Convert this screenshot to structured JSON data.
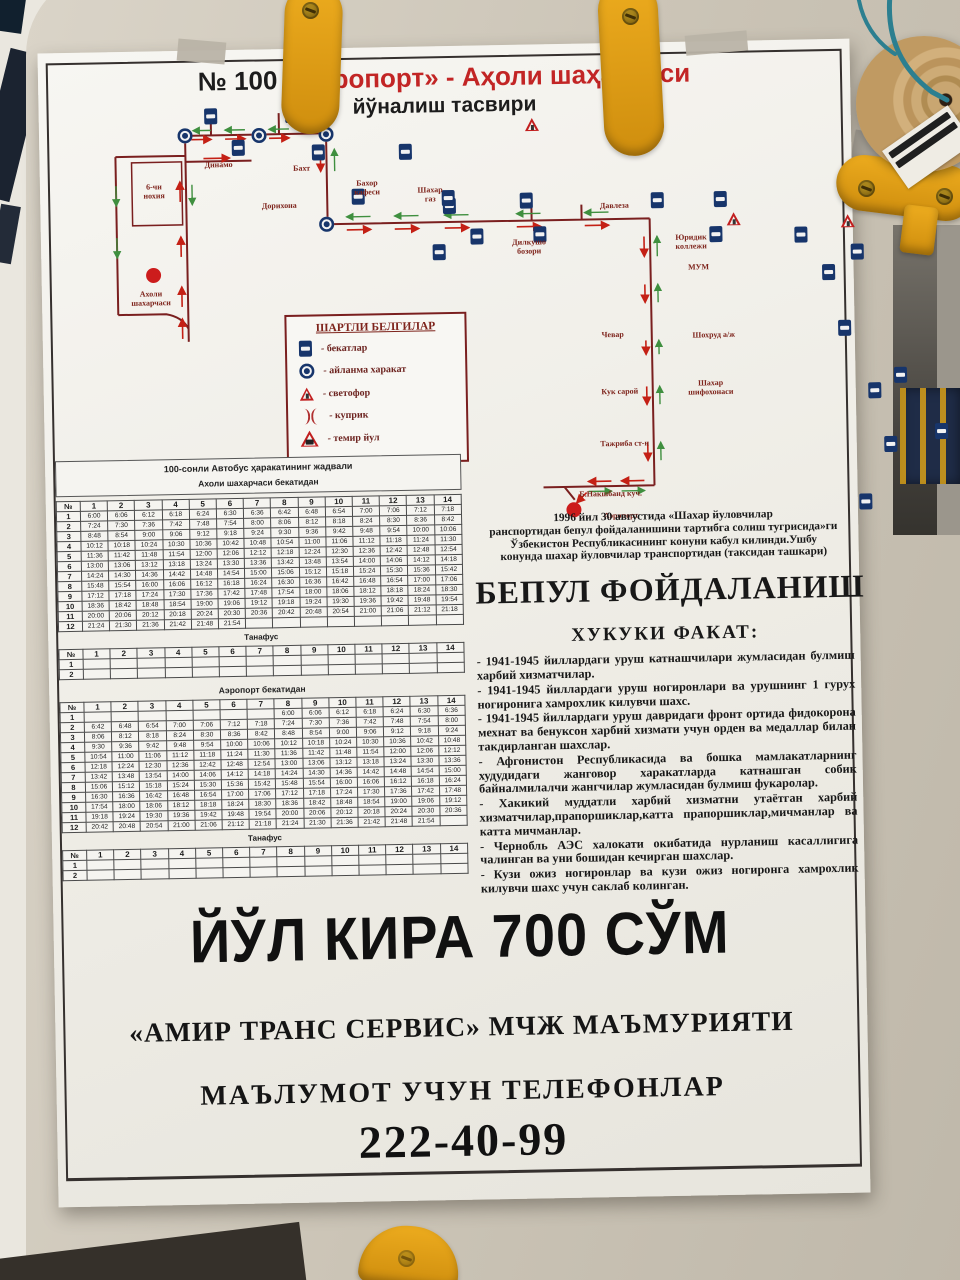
{
  "colors": {
    "poster_red": "#c22525",
    "map_road": "#7a1f1f",
    "map_blue": "#17356b",
    "arrow_red": "#c42015",
    "arrow_green": "#3f8f3f",
    "tab_yellow": "#e2a51c"
  },
  "title": {
    "no": "№ 100",
    "route": "«Аэропорт» - Аҳоли шаҳарчаси",
    "subtitle": "йўналиш тасвири"
  },
  "map": {
    "legend": {
      "title": "ШАРТЛИ БЕЛГИЛАР",
      "items": [
        {
          "icon": "bus-stop-icon",
          "label": "- бекатлар"
        },
        {
          "icon": "roundabout-icon",
          "label": "- айланма харакат"
        },
        {
          "icon": "traffic-light-icon",
          "label": "- светофор"
        },
        {
          "icon": "bridge-icon",
          "label": "- куприк"
        },
        {
          "icon": "railway-icon",
          "label": "- темир йул"
        }
      ]
    },
    "stops": [
      [
        158,
        10
      ],
      [
        226,
        10
      ],
      [
        159,
        42
      ],
      [
        226,
        48
      ],
      [
        252,
        93
      ],
      [
        287,
        49
      ],
      [
        317,
        104
      ],
      [
        381,
        100
      ],
      [
        318,
        135
      ],
      [
        368,
        134
      ],
      [
        473,
        102
      ],
      [
        523,
        102
      ],
      [
        505,
        137
      ],
      [
        577,
        139
      ],
      [
        620,
        157
      ],
      [
        578,
        177
      ],
      [
        580,
        233
      ],
      [
        622,
        281
      ],
      [
        583,
        296
      ],
      [
        585,
        350
      ],
      [
        623,
        338
      ],
      [
        533,
        407
      ],
      [
        98,
        150
      ],
      [
        95,
        96
      ]
    ],
    "roundabouts": [
      [
        132,
        29
      ],
      [
        206,
        30
      ],
      [
        273,
        30
      ],
      [
        272,
        120
      ]
    ],
    "traffic_lights": [
      [
        167,
        21
      ],
      [
        353,
        119
      ],
      [
        453,
        123
      ],
      [
        596,
        124
      ],
      [
        597,
        168
      ],
      [
        599,
        213
      ],
      [
        600,
        259
      ],
      [
        603,
        318
      ],
      [
        496,
        389
      ],
      [
        606,
        388
      ]
    ],
    "railways": [
      [
        623,
        240
      ]
    ],
    "termini": [
      [
        98,
        168
      ],
      [
        514,
        410
      ]
    ],
    "turns": [
      [
        325,
        228
      ]
    ],
    "labels": [
      {
        "x": 165,
        "y": 55,
        "t": "Динамо"
      },
      {
        "x": 248,
        "y": 60,
        "t": "Бахт"
      },
      {
        "x": 225,
        "y": 97,
        "t": "Дорихона"
      },
      {
        "x": 313,
        "y": 76,
        "t": "Бахор\nкафеси"
      },
      {
        "x": 376,
        "y": 84,
        "t": "Шахар\nгаз"
      },
      {
        "x": 100,
        "y": 76,
        "t": "6-чи\nнохия"
      },
      {
        "x": 95,
        "y": 183,
        "t": "Ахоли\nшахарчаси"
      },
      {
        "x": 474,
        "y": 138,
        "t": "Дилкушо\nбозори"
      },
      {
        "x": 560,
        "y": 103,
        "t": "Давлеза"
      },
      {
        "x": 636,
        "y": 136,
        "t": "Юридик\nколлежи"
      },
      {
        "x": 643,
        "y": 166,
        "t": "МУМ"
      },
      {
        "x": 556,
        "y": 232,
        "t": "Чевар"
      },
      {
        "x": 657,
        "y": 234,
        "t": "Шохруд а/ж"
      },
      {
        "x": 562,
        "y": 289,
        "t": "Кук сарой"
      },
      {
        "x": 653,
        "y": 282,
        "t": "Шахар\nшифохонаси"
      },
      {
        "x": 566,
        "y": 341,
        "t": "Тажриба ст-н"
      },
      {
        "x": 551,
        "y": 391,
        "t": "Б.Накшбанд куч."
      },
      {
        "x": 561,
        "y": 413,
        "t": "Аэропорт"
      }
    ]
  },
  "timetable": {
    "title": "100-сонли Автобус ҳаракатининг жадвали",
    "section1": "Ахоли шахарчаси бекатидан",
    "section2": "Аэропорт бекатидан",
    "tanafus_label": "Танафус",
    "col_headers": [
      "№",
      "1",
      "2",
      "3",
      "4",
      "5",
      "6",
      "7",
      "8",
      "9",
      "10",
      "11",
      "12",
      "13",
      "14"
    ],
    "table1_rows": [
      {
        "n": "1",
        "t": [
          "6:00",
          "6:06",
          "6:12",
          "6:18",
          "6:24",
          "6:30",
          "6:36",
          "6:42",
          "6:48",
          "6:54",
          "7:00",
          "7:06",
          "7:12",
          "7:18"
        ]
      },
      {
        "n": "2",
        "t": [
          "7:24",
          "7:30",
          "7:36",
          "7:42",
          "7:48",
          "7:54",
          "8:00",
          "8:06",
          "8:12",
          "8:18",
          "8:24",
          "8:30",
          "8:36",
          "8:42"
        ]
      },
      {
        "n": "3",
        "t": [
          "8:48",
          "8:54",
          "9:00",
          "9:06",
          "9:12",
          "9:18",
          "9:24",
          "9:30",
          "9:36",
          "9:42",
          "9:48",
          "9:54",
          "10:00",
          "10:06"
        ]
      },
      {
        "n": "4",
        "t": [
          "10:12",
          "10:18",
          "10:24",
          "10:30",
          "10:36",
          "10:42",
          "10:48",
          "10:54",
          "11:00",
          "11:06",
          "11:12",
          "11:18",
          "11:24",
          "11:30"
        ]
      },
      {
        "n": "5",
        "t": [
          "11:36",
          "11:42",
          "11:48",
          "11:54",
          "12:00",
          "12:06",
          "12:12",
          "12:18",
          "12:24",
          "12:30",
          "12:36",
          "12:42",
          "12:48",
          "12:54"
        ]
      },
      {
        "n": "6",
        "t": [
          "13:00",
          "13:06",
          "13:12",
          "13:18",
          "13:24",
          "13:30",
          "13:36",
          "13:42",
          "13:48",
          "13:54",
          "14:00",
          "14:06",
          "14:12",
          "14:18"
        ]
      },
      {
        "n": "7",
        "t": [
          "14:24",
          "14:30",
          "14:36",
          "14:42",
          "14:48",
          "14:54",
          "15:00",
          "15:06",
          "15:12",
          "15:18",
          "15:24",
          "15:30",
          "15:36",
          "15:42"
        ]
      },
      {
        "n": "8",
        "t": [
          "15:48",
          "15:54",
          "16:00",
          "16:06",
          "16:12",
          "16:18",
          "16:24",
          "16:30",
          "16:36",
          "16:42",
          "16:48",
          "16:54",
          "17:00",
          "17:06"
        ]
      },
      {
        "n": "9",
        "t": [
          "17:12",
          "17:18",
          "17:24",
          "17:30",
          "17:36",
          "17:42",
          "17:48",
          "17:54",
          "18:00",
          "18:06",
          "18:12",
          "18:18",
          "18:24",
          "18:30"
        ]
      },
      {
        "n": "10",
        "t": [
          "18:36",
          "18:42",
          "18:48",
          "18:54",
          "19:00",
          "19:06",
          "19:12",
          "19:18",
          "19:24",
          "19:30",
          "19:36",
          "19:42",
          "19:48",
          "19:54"
        ]
      },
      {
        "n": "11",
        "t": [
          "20:00",
          "20:06",
          "20:12",
          "20:18",
          "20:24",
          "20:30",
          "20:36",
          "20:42",
          "20:48",
          "20:54",
          "21:00",
          "21:06",
          "21:12",
          "21:18"
        ]
      },
      {
        "n": "12",
        "t": [
          "21:24",
          "21:30",
          "21:36",
          "21:42",
          "21:48",
          "21:54",
          "",
          "",
          "",
          "",
          "",
          "",
          "",
          ""
        ]
      }
    ],
    "table2_rows": [
      {
        "n": "1",
        "t": [
          "",
          "",
          "",
          "",
          "",
          "",
          "",
          "6:00",
          "6:06",
          "6:12",
          "6:18",
          "6:24",
          "6:30",
          "6:36"
        ]
      },
      {
        "n": "2",
        "t": [
          "6:42",
          "6:48",
          "6:54",
          "7:00",
          "7:06",
          "7:12",
          "7:18",
          "7:24",
          "7:30",
          "7:36",
          "7:42",
          "7:48",
          "7:54",
          "8:00"
        ]
      },
      {
        "n": "3",
        "t": [
          "8:06",
          "8:12",
          "8:18",
          "8:24",
          "8:30",
          "8:36",
          "8:42",
          "8:48",
          "8:54",
          "9:00",
          "9:06",
          "9:12",
          "9:18",
          "9:24"
        ]
      },
      {
        "n": "4",
        "t": [
          "9:30",
          "9:36",
          "9:42",
          "9:48",
          "9:54",
          "10:00",
          "10:06",
          "10:12",
          "10:18",
          "10:24",
          "10:30",
          "10:36",
          "10:42",
          "10:48"
        ]
      },
      {
        "n": "5",
        "t": [
          "10:54",
          "11:00",
          "11:06",
          "11:12",
          "11:18",
          "11:24",
          "11:30",
          "11:36",
          "11:42",
          "11:48",
          "11:54",
          "12:00",
          "12:06",
          "12:12"
        ]
      },
      {
        "n": "6",
        "t": [
          "12:18",
          "12:24",
          "12:30",
          "12:36",
          "12:42",
          "12:48",
          "12:54",
          "13:00",
          "13:06",
          "13:12",
          "13:18",
          "13:24",
          "13:30",
          "13:36"
        ]
      },
      {
        "n": "7",
        "t": [
          "13:42",
          "13:48",
          "13:54",
          "14:00",
          "14:06",
          "14:12",
          "14:18",
          "14:24",
          "14:30",
          "14:36",
          "14:42",
          "14:48",
          "14:54",
          "15:00"
        ]
      },
      {
        "n": "8",
        "t": [
          "15:06",
          "15:12",
          "15:18",
          "15:24",
          "15:30",
          "15:36",
          "15:42",
          "15:48",
          "15:54",
          "16:00",
          "16:06",
          "16:12",
          "16:18",
          "16:24"
        ]
      },
      {
        "n": "9",
        "t": [
          "16:30",
          "16:36",
          "16:42",
          "16:48",
          "16:54",
          "17:00",
          "17:06",
          "17:12",
          "17:18",
          "17:24",
          "17:30",
          "17:36",
          "17:42",
          "17:48"
        ]
      },
      {
        "n": "10",
        "t": [
          "17:54",
          "18:00",
          "18:06",
          "18:12",
          "18:18",
          "18:24",
          "18:30",
          "18:36",
          "18:42",
          "18:48",
          "18:54",
          "19:00",
          "19:06",
          "19:12"
        ]
      },
      {
        "n": "11",
        "t": [
          "19:18",
          "19:24",
          "19:30",
          "19:36",
          "19:42",
          "19:48",
          "19:54",
          "20:00",
          "20:06",
          "20:12",
          "20:18",
          "20:24",
          "20:30",
          "20:36"
        ]
      },
      {
        "n": "12",
        "t": [
          "20:42",
          "20:48",
          "20:54",
          "21:00",
          "21:06",
          "21:12",
          "21:18",
          "21:24",
          "21:30",
          "21:36",
          "21:42",
          "21:48",
          "21:54",
          ""
        ]
      }
    ],
    "tanafus_rows": [
      {
        "n": "1",
        "t": [
          "",
          "",
          "",
          "",
          "",
          "",
          "",
          "",
          "",
          "",
          "",
          "",
          "",
          ""
        ]
      },
      {
        "n": "2",
        "t": [
          "",
          "",
          "",
          "",
          "",
          "",
          "",
          "",
          "",
          "",
          "",
          "",
          "",
          ""
        ]
      }
    ]
  },
  "rights": {
    "intro_lines": [
      "1996 йил 30 августида «Шахар йуловчилар",
      "ранспортидан бепул фойдаланишини тартибга солиш тугрисида»ги",
      "Ўзбекистон Республикасининг конуни кабул килинди.Ушбу",
      "конунда шахар йуловчилар транспортидан (таксидан ташкари)"
    ],
    "free_title": "БЕПУЛ ФОЙДАЛАНИШ",
    "law_title": "ХУКУКИ ФАКАТ:",
    "bullets": [
      "- 1941-1945 йиллардаги уруш катнашчилари жумласидан булмиш харбий хизматчилар.",
      "- 1941-1945 йиллардаги уруш ногиронлари ва урушнинг 1 гурух ногиронига хамрохлик килувчи шахс.",
      "- 1941-1945 йиллардаги уруш давридаги фронт ортида фидокорона мехнат ва бенуксон харбий хизмати учун орден ва медаллар билан такдирланган шахслар.",
      "- Афгонистон Республикасида ва бошка мамлакатларнинг худудидаги жанговор харакатларда катнашган собик байналмилалчи жангчилар жумласидан булмиш фукаролар.",
      "- Хакикий муддатли харбий хизматни утаётган харбий хизматчилар,прапоршиклар,катта прапоршиклар,мичманлар ва катта мичманлар.",
      "- Чернобль АЭС халокати окибатида нурланиш касаллигига чалинган ва уни бошидан кечирган шахслар.",
      "- Кузи ожиз ногиронлар ва кузи ожиз ногиронга хамрохлик килувчи шахс учун саклаб колинган."
    ]
  },
  "footer": {
    "fare": "ЙЎЛ КИРА 700 СЎМ",
    "company": "«АМИР ТРАНС СЕРВИС» МЧЖ МАЪМУРИЯТИ",
    "phones_label": "МАЪЛУМОТ УЧУН ТЕЛЕФОНЛАР",
    "phone": "222-40-99"
  }
}
